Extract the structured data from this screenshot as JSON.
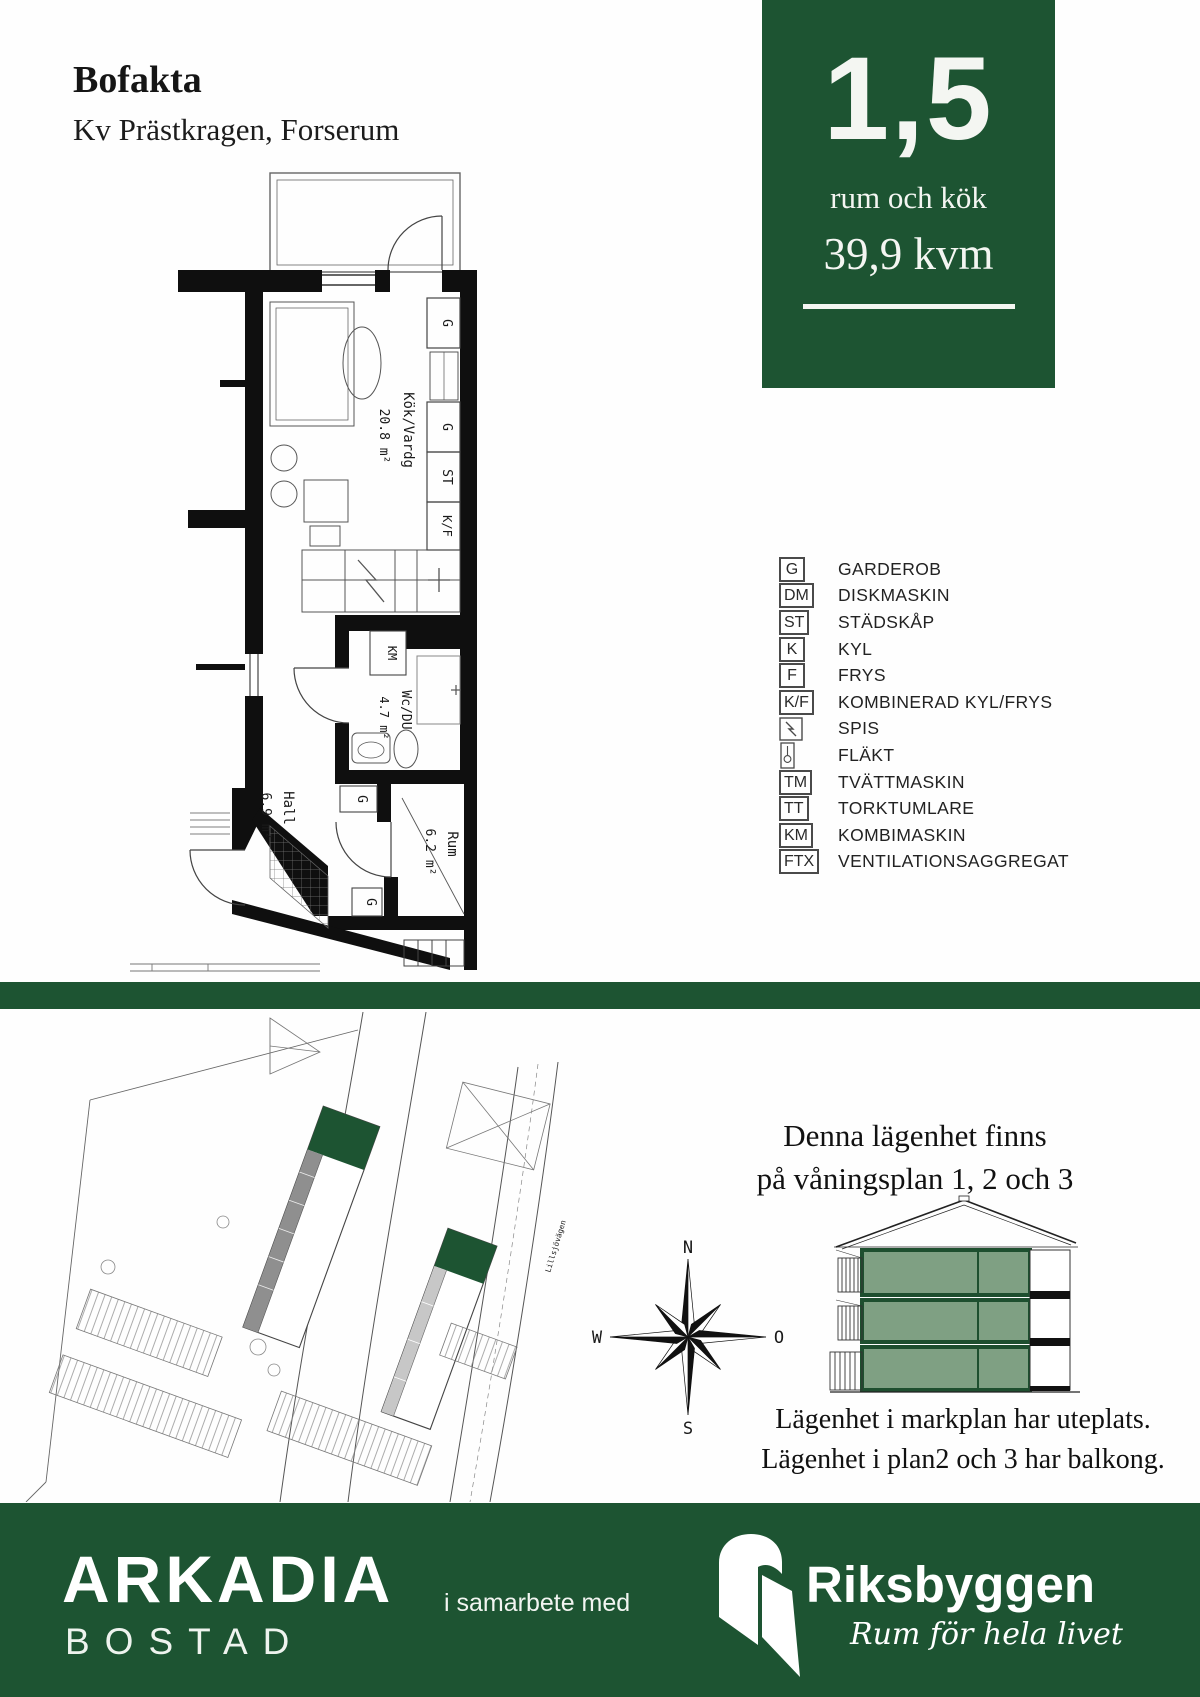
{
  "header": {
    "title": "Bofakta",
    "subtitle": "Kv Prästkragen, Forserum"
  },
  "info_box": {
    "value": "1,5",
    "unit_label": "rum och kök",
    "area": "39,9 kvm"
  },
  "floor_plan": {
    "rooms": [
      {
        "name": "Kök/Vardg",
        "area": "20.8 m²"
      },
      {
        "name": "Wc/DU",
        "area": "4.7 m²"
      },
      {
        "name": "Hall",
        "area": "6.9 m²"
      },
      {
        "name": "Rum",
        "area": "6.2 m²"
      }
    ],
    "markers": {
      "g_top": "G",
      "g_mid": "G",
      "st": "ST",
      "kf": "K/F",
      "km": "KM",
      "g_hall": "G",
      "g_rum": "G"
    }
  },
  "legend": {
    "items": [
      {
        "code": "G",
        "label": "GARDEROB"
      },
      {
        "code": "DM",
        "label": "DISKMASKIN"
      },
      {
        "code": "ST",
        "label": "STÄDSKÅP"
      },
      {
        "code": "K",
        "label": "KYL"
      },
      {
        "code": "F",
        "label": "FRYS"
      },
      {
        "code": "K/F",
        "label": "KOMBINERAD KYL/FRYS"
      },
      {
        "icon": "spis-icon",
        "label": "SPIS"
      },
      {
        "icon": "flakt-icon",
        "label": "FLÄKT"
      },
      {
        "code": "TM",
        "label": "TVÄTTMASKIN"
      },
      {
        "code": "TT",
        "label": "TORKTUMLARE"
      },
      {
        "code": "KM",
        "label": "KOMBIMASKIN"
      },
      {
        "code": "FTX",
        "label": "VENTILATIONSAGGREGAT"
      }
    ]
  },
  "site_plan": {
    "road_label": "Lillsjövägen"
  },
  "compass": {
    "north": "N",
    "west": "W",
    "east": "O",
    "south": "S"
  },
  "availability": {
    "line1": "Denna lägenhet finns",
    "line2": "på våningsplan 1, 2 och 3",
    "note1": "Lägenhet i markplan har uteplats.",
    "note2": "Lägenhet i plan2 och 3 har balkong."
  },
  "footer": {
    "brand": "ARKADIA",
    "brand_sub": "BOSTAD",
    "cooperation": "i samarbete med",
    "partner": "Riksbyggen",
    "tagline": "Rum för hela livet"
  },
  "colors": {
    "green_dark": "#1d5432",
    "green_floor": "#7fa083"
  }
}
